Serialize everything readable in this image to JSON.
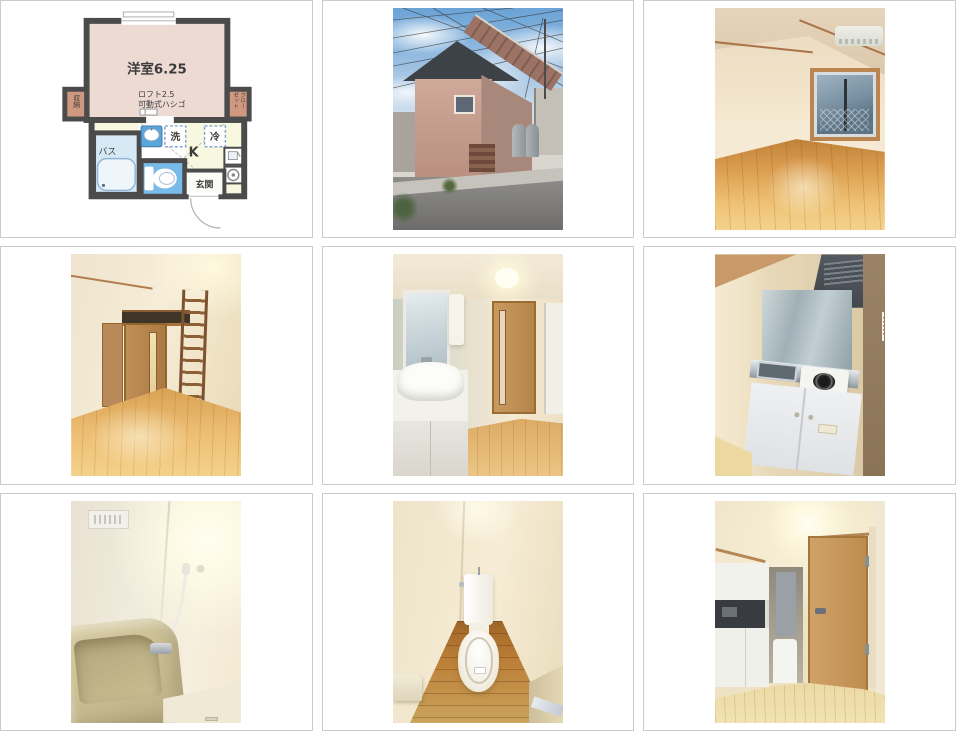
{
  "page": {
    "background": "#ffffff",
    "cell_border_color": "#cbcbcb"
  },
  "gallery": {
    "cells": [
      {
        "name": "floorplan-diagram"
      },
      {
        "name": "building-exterior-photo"
      },
      {
        "name": "western-room-window-photo"
      },
      {
        "name": "western-room-loft-ladder-photo"
      },
      {
        "name": "washbasin-room-photo"
      },
      {
        "name": "kitchen-photo"
      },
      {
        "name": "bathroom-photo"
      },
      {
        "name": "toilet-photo"
      },
      {
        "name": "hallway-kitchen-door-photo"
      }
    ]
  },
  "floorplan": {
    "labels": {
      "main_room": "洋室6.25",
      "loft_line1": "ロフト2.5",
      "loft_line2": "可動式ハシゴ",
      "storage": "収納",
      "closet_col_right": "クロー",
      "closet_col_left": "ゼット",
      "bath": "バス",
      "wash": "洗",
      "kitchen": "K",
      "fridge": "冷",
      "entrance": "玄関"
    },
    "colors": {
      "wall": "#4b4b4b",
      "main_room_fill": "#eddbd3",
      "closet_fill": "#d0987f",
      "kitchen_fill": "#f8f8e0",
      "bath_fill": "#d8e9f6",
      "toilet_fill": "#77bbe8",
      "sink_fill": "#58a6db",
      "dashed_line": "#88a6d4"
    }
  }
}
